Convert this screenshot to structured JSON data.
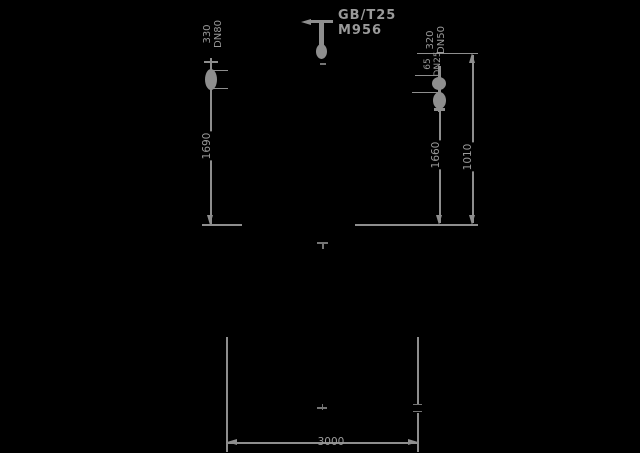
{
  "labels": {
    "left_nozzle": {
      "line1": "330",
      "line2": "DN80"
    },
    "center_nozzle": {
      "line1": "GB/T25",
      "line2": "M956"
    },
    "right_nozzle_upper": {
      "line1": "320",
      "line2": "DN50"
    },
    "right_nozzle_lower": {
      "line1": "65",
      "line2": "DN25"
    }
  },
  "dimensions": {
    "left_height": "1690",
    "right_height": "1660",
    "right_outer_height": "1010",
    "bottom_width": "3000"
  },
  "colors": {
    "background": "#000000",
    "line": "#8e8e8e",
    "text": "#9a9a9a",
    "dim_mark": "#757575"
  }
}
